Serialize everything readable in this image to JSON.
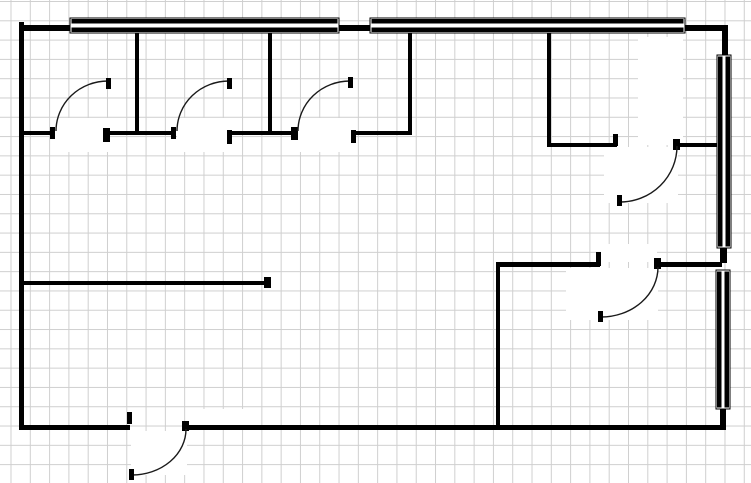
{
  "app": {
    "name": "floor-plan-drawing",
    "title": "Floor Plan"
  },
  "canvas": {
    "width": 751,
    "height": 483,
    "background": "#ffffff",
    "ink_color": "#000000",
    "grid": {
      "spacing_x": 19.3,
      "spacing_y": 19.3,
      "offset_x": 10.5,
      "offset_y": 1.0,
      "color": "#cfcfcf"
    }
  },
  "floor_plan": {
    "patches": [
      [
        55,
        118,
        54,
        34
      ],
      [
        177,
        118,
        54,
        34
      ],
      [
        298,
        118,
        58,
        34
      ],
      [
        638,
        37,
        45,
        108
      ],
      [
        604,
        147,
        74,
        56
      ],
      [
        601,
        244,
        56,
        18
      ],
      [
        566,
        268,
        92,
        52
      ],
      [
        131,
        431,
        56,
        44
      ],
      [
        187,
        409,
        62,
        17
      ]
    ],
    "walls": [
      {
        "name": "left-exterior-wall",
        "x": 19,
        "y": 22,
        "w": 5,
        "h": 408
      },
      {
        "name": "top-exterior-wall",
        "x": 19,
        "y": 25,
        "w": 708,
        "h": 6
      },
      {
        "name": "right-exterior-wall-upper",
        "x": 722,
        "y": 25,
        "w": 6,
        "h": 31
      },
      {
        "name": "right-exterior-wall-middle",
        "x": 720,
        "y": 247,
        "w": 7,
        "h": 16
      },
      {
        "name": "right-exterior-wall-lower",
        "x": 720,
        "y": 407,
        "w": 6,
        "h": 23
      },
      {
        "name": "bottom-exterior-wall-left",
        "x": 19,
        "y": 425,
        "w": 111,
        "h": 5
      },
      {
        "name": "bottom-exterior-wall-right",
        "x": 186,
        "y": 425,
        "w": 539,
        "h": 5
      },
      {
        "name": "partition-1",
        "x": 135,
        "y": 31,
        "w": 4,
        "h": 104
      },
      {
        "name": "partition-2",
        "x": 268,
        "y": 31,
        "w": 4,
        "h": 104
      },
      {
        "name": "partition-3",
        "x": 408,
        "y": 31,
        "w": 4,
        "h": 104
      },
      {
        "name": "partition-4",
        "x": 547,
        "y": 31,
        "w": 4,
        "h": 116
      },
      {
        "name": "corridor-wall-a",
        "x": 19,
        "y": 131,
        "w": 36,
        "h": 4
      },
      {
        "name": "corridor-wall-b",
        "x": 104,
        "y": 131,
        "w": 72,
        "h": 4
      },
      {
        "name": "corridor-wall-c",
        "x": 228,
        "y": 131,
        "w": 69,
        "h": 4
      },
      {
        "name": "corridor-wall-d",
        "x": 352,
        "y": 131,
        "w": 60,
        "h": 4
      },
      {
        "name": "office-wall-left",
        "x": 547,
        "y": 143,
        "w": 70,
        "h": 4
      },
      {
        "name": "office-wall-right",
        "x": 677,
        "y": 143,
        "w": 43,
        "h": 4
      },
      {
        "name": "mid-partition",
        "x": 19,
        "y": 281,
        "w": 250,
        "h": 4
      },
      {
        "name": "room-wall-vertical",
        "x": 496,
        "y": 264,
        "w": 4,
        "h": 164
      },
      {
        "name": "room-wall-top-left",
        "x": 496,
        "y": 262,
        "w": 104,
        "h": 5
      },
      {
        "name": "room-wall-top-right",
        "x": 658,
        "y": 262,
        "w": 64,
        "h": 5
      }
    ],
    "windows": [
      {
        "name": "window-top-left",
        "x": 70,
        "y": 18,
        "w": 269,
        "h": 15
      },
      {
        "name": "window-top-right",
        "x": 370,
        "y": 18,
        "w": 315,
        "h": 15
      },
      {
        "name": "window-right-upper",
        "x": 717,
        "y": 55,
        "w": 14,
        "h": 193
      },
      {
        "name": "window-right-lower",
        "x": 716,
        "y": 270,
        "w": 14,
        "h": 139
      }
    ],
    "doors": [
      {
        "name": "door-1",
        "arc": "M 56 131 A 52 50 0 0 1 108 81",
        "tick": [
          106,
          78,
          5,
          11
        ]
      },
      {
        "name": "door-2",
        "arc": "M 177 131 A 52 50 0 0 1 229 81",
        "tick": [
          227,
          78,
          5,
          11
        ]
      },
      {
        "name": "door-3",
        "arc": "M 298 131 A 52 50 0 0 1 350 81",
        "tick": [
          348,
          77,
          5,
          11
        ]
      },
      {
        "name": "door-4",
        "arc": "M 677 146 A 57 56 0 0 1 620 202",
        "tick": [
          617,
          195,
          5,
          11
        ]
      },
      {
        "name": "door-5",
        "arc": "M 658 267 A 57 50 0 0 1 601 317",
        "tick": [
          598,
          311,
          5,
          11
        ]
      },
      {
        "name": "door-entry",
        "arc": "M 186 429 A 54 46 0 0 1 132 475",
        "tick": [
          129,
          469,
          5,
          11
        ]
      }
    ],
    "jambs": [
      [
        50,
        127,
        5,
        12
      ],
      [
        103,
        128,
        7,
        14
      ],
      [
        171,
        127,
        5,
        12
      ],
      [
        227,
        130,
        5,
        14
      ],
      [
        291,
        127,
        7,
        13
      ],
      [
        351,
        130,
        5,
        13
      ],
      [
        613,
        134,
        5,
        12
      ],
      [
        673,
        139,
        7,
        11
      ],
      [
        596,
        252,
        5,
        14
      ],
      [
        654,
        258,
        7,
        11
      ],
      [
        264,
        277,
        7,
        11
      ],
      [
        127,
        412,
        5,
        12
      ],
      [
        182,
        421,
        7,
        10
      ]
    ]
  }
}
